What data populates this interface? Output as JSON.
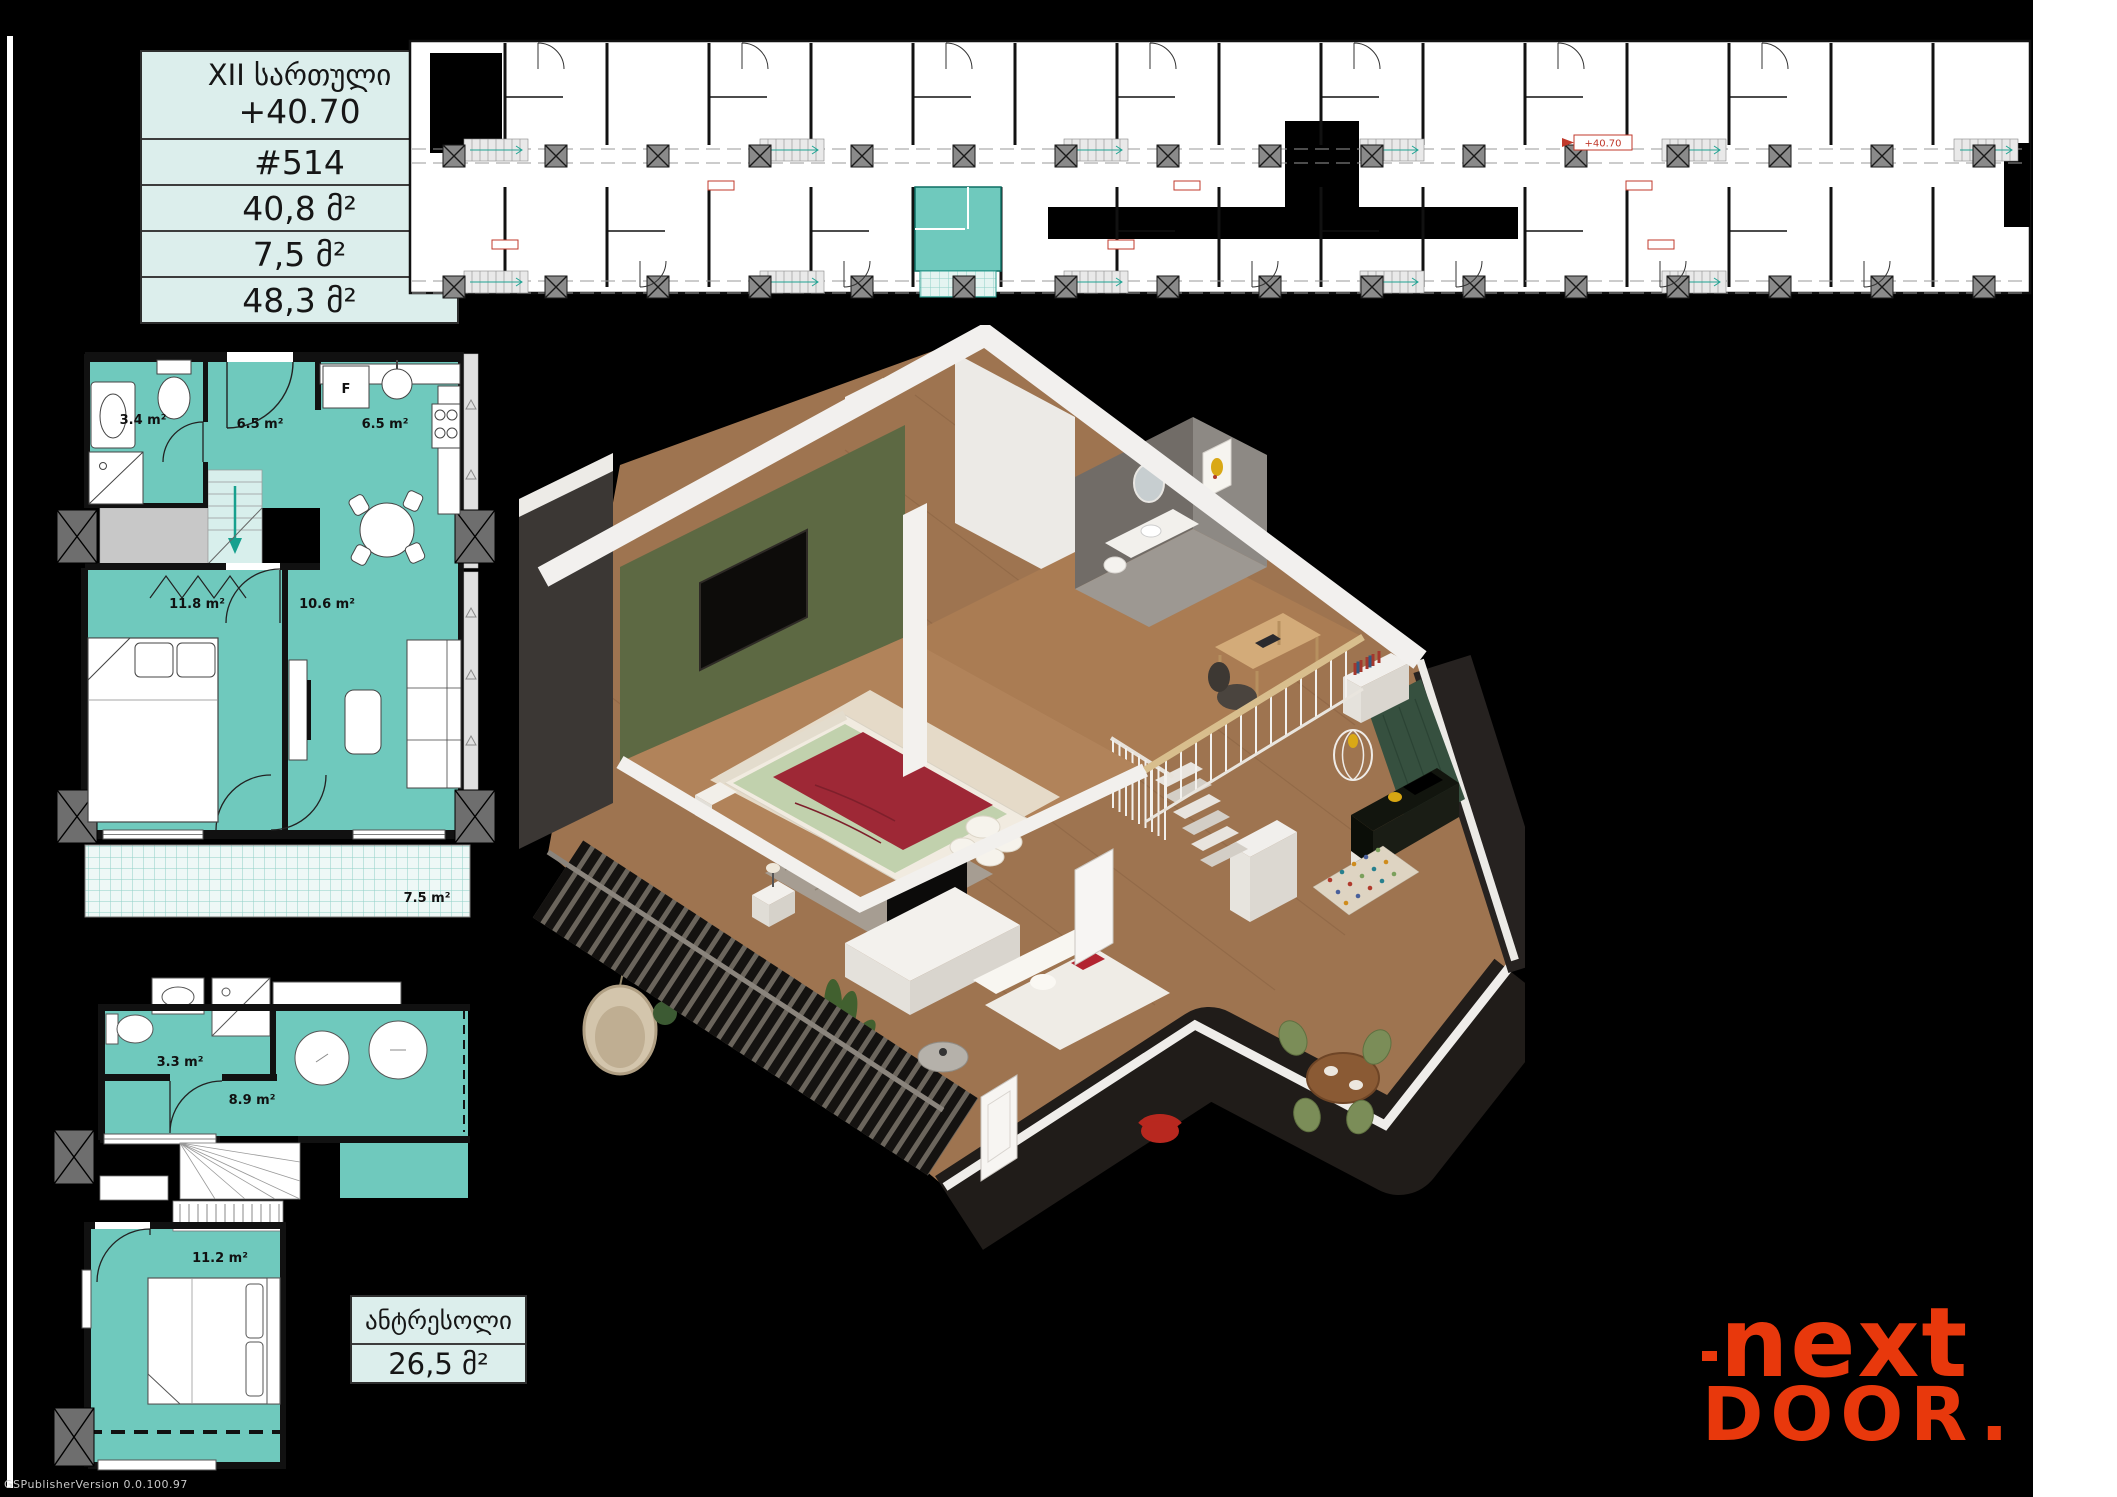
{
  "info_table": {
    "floor": "XII სართული",
    "elevation": "+40.70",
    "apartment": "#514",
    "area_living": "40,8 მ²",
    "area_summer": "7,5 მ²",
    "area_total": "48,3 მ²"
  },
  "site_plan": {
    "elevation_label": "+40.70"
  },
  "floor_plan_main": {
    "bathroom_area": "3.4 m²",
    "hall_area": "6.5 m²",
    "kitchen_area": "6.5 m²",
    "bedroom_area": "11.8 m²",
    "living_area": "10.6 m²",
    "balcony_area": "7.5 m²",
    "fridge_label": "F"
  },
  "floor_plan_mezzanine": {
    "bathroom_area": "3.3 m²",
    "hall_area": "8.9 m²",
    "bedroom_area": "11.2 m²"
  },
  "mezzanine_box": {
    "title": "ანტრესოლი",
    "area": "26,5 მ²"
  },
  "logo": {
    "line1": "next",
    "line2": "DOOR",
    "dot": "."
  },
  "watermark": "GSPublisherVersion 0.0.100.97",
  "colors": {
    "highlight_teal": "#6fc9bd",
    "logo_orange": "#e8380c",
    "table_bg": "#dceeec"
  }
}
